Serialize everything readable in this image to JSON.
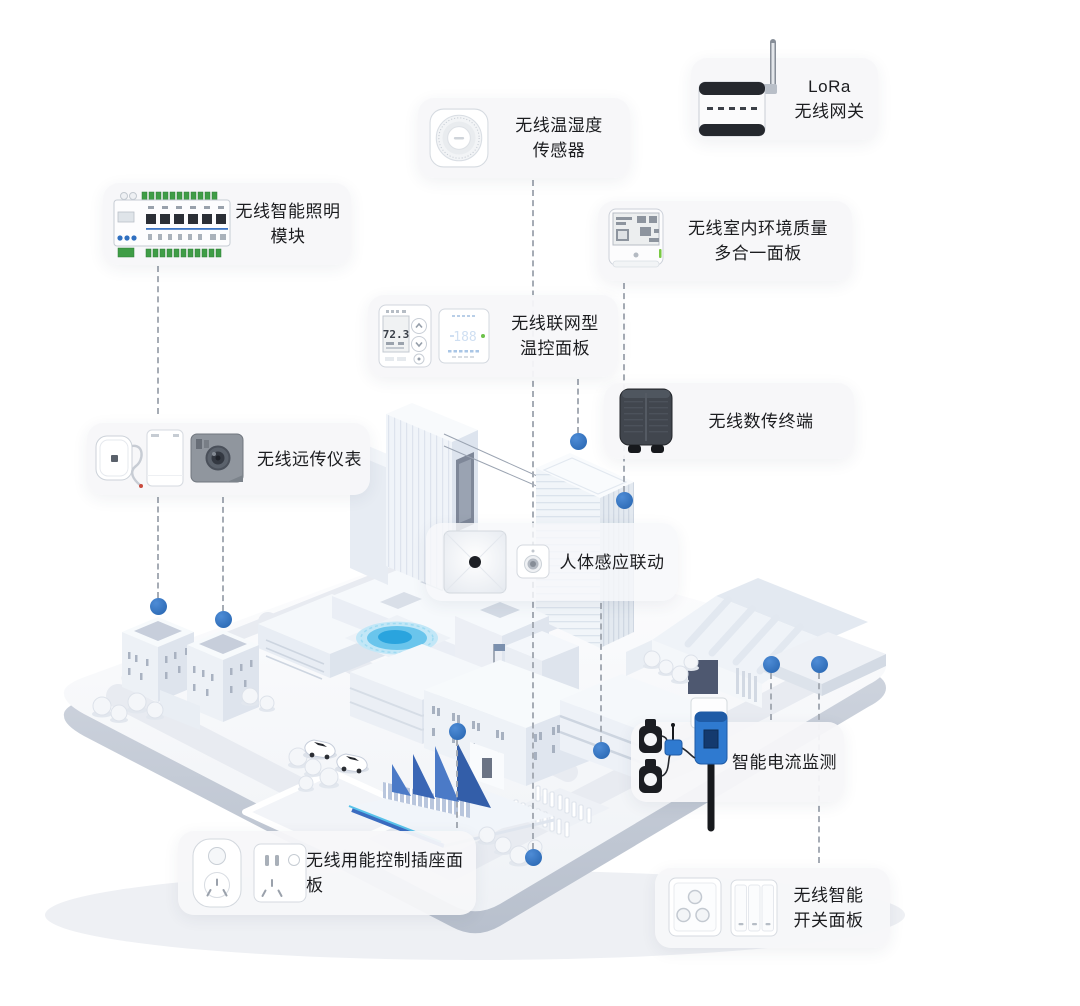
{
  "colors": {
    "accent_blue": "#2f6fc0",
    "node_dot_blue": "#2b6cbf",
    "dashed_line_gray": "#a6acb5",
    "card_bg": "#f6f7f8",
    "text": "#1b1c1f",
    "pool_blue": "#2aa4de",
    "bleacher_blue": "#3b6cc0",
    "terminal_device_dark": "#41464e",
    "ct_clamp_black": "#1b1d22",
    "plug_blue": "#2f7ad0",
    "terminal_green": "#3f9d46",
    "led_green": "#79c943"
  },
  "cards": [
    {
      "id": "lora-gateway",
      "line1": "LoRa",
      "line2": "无线网关",
      "device_icon": "lora-gateway-device"
    },
    {
      "id": "temp-humidity",
      "line1": "无线温湿度",
      "line2": "传感器",
      "device_icon": "temp-humidity-sensor-device"
    },
    {
      "id": "lighting-module",
      "line1": "无线智能照明",
      "line2": "模块",
      "device_icon": "lighting-module-device"
    },
    {
      "id": "env-quality",
      "line1": "无线室内环境质量",
      "line2": "多合一面板",
      "device_icon": "env-quality-panel-device"
    },
    {
      "id": "thermostat",
      "line1": "无线联网型",
      "line2": "温控面板",
      "device_icon": "thermostat-panels-device",
      "display_left": "72.3",
      "display_right": "188"
    },
    {
      "id": "data-terminal",
      "line1": "无线数传终端",
      "line2": "",
      "device_icon": "data-terminal-device"
    },
    {
      "id": "remote-meter",
      "line1": "无线远传仪表",
      "line2": "",
      "device_icon": "remote-meter-devices"
    },
    {
      "id": "presence-linkage",
      "line1": "人体感应联动",
      "line2": "",
      "device_icon": "presence-sensor-devices"
    },
    {
      "id": "current-monitor",
      "line1": "智能电流监测",
      "line2": "",
      "device_icon": "current-monitor-devices"
    },
    {
      "id": "socket-panel",
      "line1": "无线用能控制插座面板",
      "line2": "",
      "device_icon": "socket-panel-devices"
    },
    {
      "id": "switch-panel",
      "line1": "无线智能",
      "line2": "开关面板",
      "device_icon": "switch-panel-devices"
    }
  ],
  "connectors": [
    {
      "id": "lighting-to-meter",
      "x": 158,
      "y1": 266,
      "y2": 414,
      "dot": null
    },
    {
      "id": "meter-to-building-a",
      "x": 158,
      "y1": 497,
      "y2": 598,
      "dot": {
        "x": 158,
        "y": 606
      }
    },
    {
      "id": "meter-to-building-b",
      "x": 223,
      "y1": 497,
      "y2": 611,
      "dot": {
        "x": 223,
        "y": 619
      }
    },
    {
      "id": "humidity-sensor-drop",
      "x": 533,
      "y1": 180,
      "y2": 849,
      "dot": {
        "x": 533,
        "y": 857
      }
    },
    {
      "id": "thermostat-to-tower-roof",
      "x": 578,
      "y1": 379,
      "y2": 433,
      "dot": {
        "x": 578,
        "y": 441
      }
    },
    {
      "id": "env-panel-to-tower",
      "x": 624,
      "y1": 283,
      "y2": 492,
      "dot": {
        "x": 624,
        "y": 500
      }
    },
    {
      "id": "presence-to-building",
      "x": 601,
      "y1": 603,
      "y2": 742,
      "dot": {
        "x": 601,
        "y": 750
      }
    },
    {
      "id": "socket-to-building",
      "x": 457,
      "y1": 740,
      "y2": 828,
      "dot": {
        "x": 457,
        "y": 731
      }
    },
    {
      "id": "current-to-warehouse",
      "x": 771,
      "y1": 673,
      "y2": 720,
      "dot": {
        "x": 771,
        "y": 664
      }
    },
    {
      "id": "switch-to-yard",
      "x": 819,
      "y1": 673,
      "y2": 863,
      "front": true,
      "dot": {
        "x": 819,
        "y": 664
      }
    }
  ]
}
